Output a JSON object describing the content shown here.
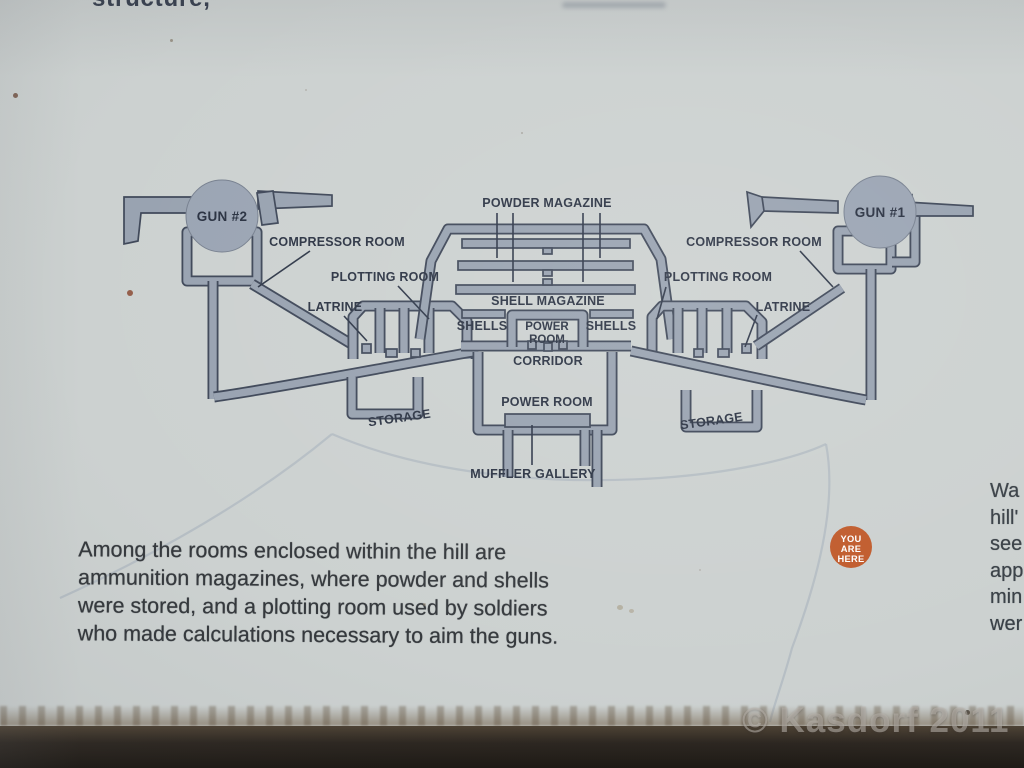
{
  "photo": {
    "watermark": "© Kasdorf 2011"
  },
  "sign": {
    "top_partial_text": "structure,",
    "caption_lines": [
      "Among the rooms enclosed within the hill are",
      "ammunition magazines, where powder and shells",
      "were stored, and a plotting room used by soldiers",
      "who made calculations necessary to aim the guns."
    ],
    "right_edge_partial_lines": [
      "Wa",
      "hill'",
      "see",
      "app",
      "min",
      "wer"
    ]
  },
  "diagram": {
    "gun2_label": "GUN #2",
    "gun1_label": "GUN #1",
    "powder_magazine": "POWDER MAGAZINE",
    "compressor_room_left": "COMPRESSOR ROOM",
    "compressor_room_right": "COMPRESSOR ROOM",
    "plotting_room_left": "PLOTTING ROOM",
    "plotting_room_right": "PLOTTING ROOM",
    "latrine_left": "LATRINE",
    "latrine_right": "LATRINE",
    "shell_magazine": "SHELL MAGAZINE",
    "shells_left": "SHELLS",
    "shells_right": "SHELLS",
    "power_room_upper_line1": "POWER",
    "power_room_upper_line2": "ROOM",
    "corridor": "CORRIDOR",
    "storage_left": "STORAGE",
    "storage_right": "STORAGE",
    "power_room_lower": "POWER ROOM",
    "muffler_gallery": "MUFFLER GALLERY",
    "you_are_here": {
      "line1": "YOU",
      "line2": "ARE",
      "line3": "HERE"
    },
    "colors": {
      "wall_fill": "#98a2b0",
      "wall_outline": "#3e4758",
      "label_text": "#2b3343",
      "marker": "#c05b2c",
      "trail": "#b2bbc2",
      "sign_background": "#ccd1d0",
      "ground_band": "#2c2620"
    }
  }
}
